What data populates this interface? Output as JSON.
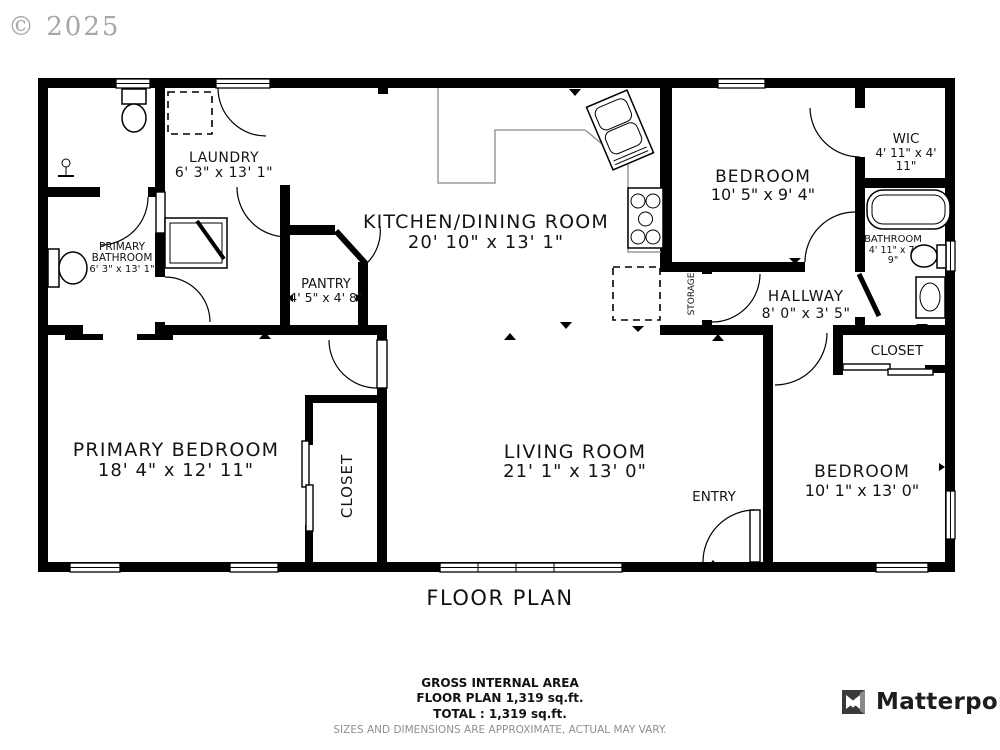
{
  "copyright": "© 2025",
  "title": "FLOOR PLAN",
  "rooms": {
    "laundry": {
      "name": "LAUNDRY",
      "dims": "6' 3\" x 13' 1\""
    },
    "kitchen": {
      "name": "KITCHEN/DINING ROOM",
      "dims": "20' 10\" x 13' 1\""
    },
    "pantry": {
      "name": "PANTRY",
      "dims": "4' 5\" x 4' 8\""
    },
    "bedroom_top": {
      "name": "BEDROOM",
      "dims": "10' 5\" x 9' 4\""
    },
    "wic": {
      "name": "WIC",
      "dims_line1": "4' 11\" x 4'",
      "dims_line2": "11\""
    },
    "bathroom_right": {
      "name": "BATHROOM",
      "dims_line1": "4' 11\" x 7'",
      "dims_line2": "9\""
    },
    "primary_bathroom": {
      "name_line1": "PRIMARY",
      "name_line2": "BATHROOM",
      "dims": "6' 3\" x 13' 1\""
    },
    "hallway": {
      "name": "HALLWAY",
      "dims": "8' 0\" x 3' 5\""
    },
    "closet_hall": {
      "name": "CLOSET"
    },
    "storage": {
      "name": "STORAGE"
    },
    "primary_bedroom": {
      "name": "PRIMARY BEDROOM",
      "dims": "18' 4\" x 12' 11\""
    },
    "closet_primary": {
      "name": "CLOSET"
    },
    "living_room": {
      "name": "LIVING ROOM",
      "dims": "21' 1\" x 13' 0\""
    },
    "entry": {
      "name": "ENTRY"
    },
    "bedroom_bottom": {
      "name": "BEDROOM",
      "dims": "10' 1\" x 13' 0\""
    }
  },
  "footer": {
    "area_title": "GROSS INTERNAL AREA",
    "area_line1": "FLOOR PLAN 1,319 sq.ft.",
    "area_line2": "TOTAL :  1,319 sq.ft.",
    "disclaimer": "SIZES AND DIMENSIONS ARE APPROXIMATE, ACTUAL MAY VARY."
  },
  "branding": {
    "logo_text": "Matterport"
  },
  "colors": {
    "wall": "#000000",
    "counter_line": "#9a9a9a",
    "copyright_gray": "#a6a6a6",
    "disclaimer_gray": "#8f8f8f",
    "logo_text": "#1d1d1f"
  }
}
